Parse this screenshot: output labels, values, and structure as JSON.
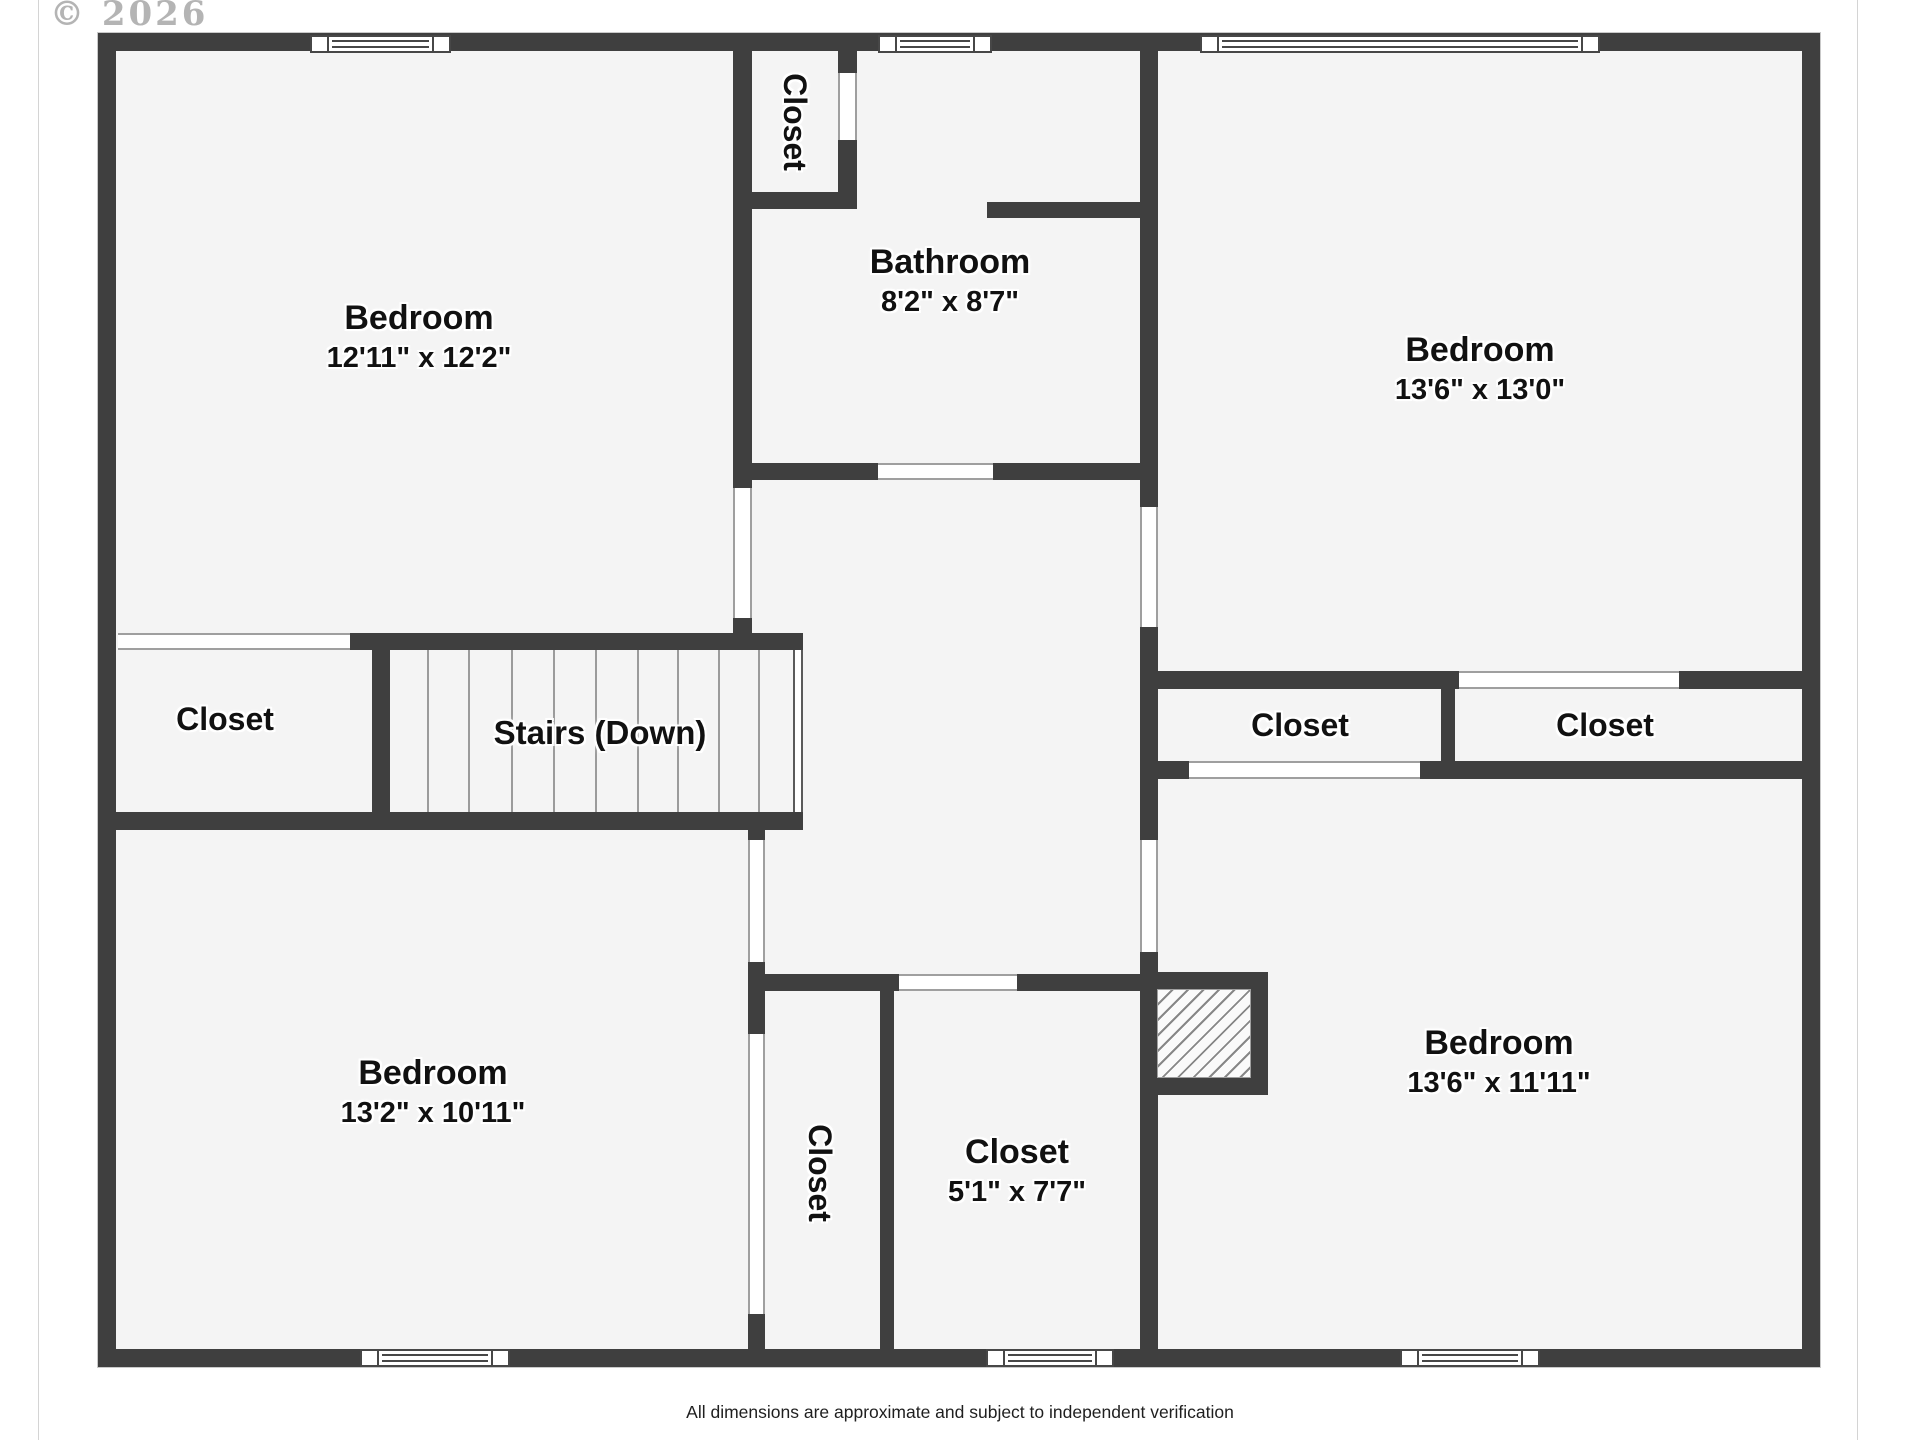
{
  "page": {
    "copyright": "© 2026",
    "disclaimer": "All dimensions are approximate and subject to independent verification"
  },
  "colors": {
    "wall": "#3f3f3f",
    "floor": "#f4f4f4",
    "door_outline": "#9f9f9f",
    "text": "#111111",
    "watermark": "#b4b4b4"
  },
  "rooms": {
    "bedroom_top_left": {
      "name": "Bedroom",
      "dims": "12'11\" x 12'2\""
    },
    "closet_top": {
      "name": "Closet"
    },
    "bathroom": {
      "name": "Bathroom",
      "dims": "8'2\" x 8'7\""
    },
    "bedroom_top_right": {
      "name": "Bedroom",
      "dims": "13'6\" x 13'0\""
    },
    "closet_mid_left": {
      "name": "Closet"
    },
    "stairs": {
      "name": "Stairs (Down)"
    },
    "closet_right_1": {
      "name": "Closet"
    },
    "closet_right_2": {
      "name": "Closet"
    },
    "bedroom_bottom_left": {
      "name": "Bedroom",
      "dims": "13'2\" x 10'11\""
    },
    "closet_bottom_vertical": {
      "name": "Closet"
    },
    "closet_bottom": {
      "name": "Closet",
      "dims": "5'1\" x 7'7\""
    },
    "bedroom_bottom_right": {
      "name": "Bedroom",
      "dims": "13'6\" x 11'11\""
    }
  }
}
